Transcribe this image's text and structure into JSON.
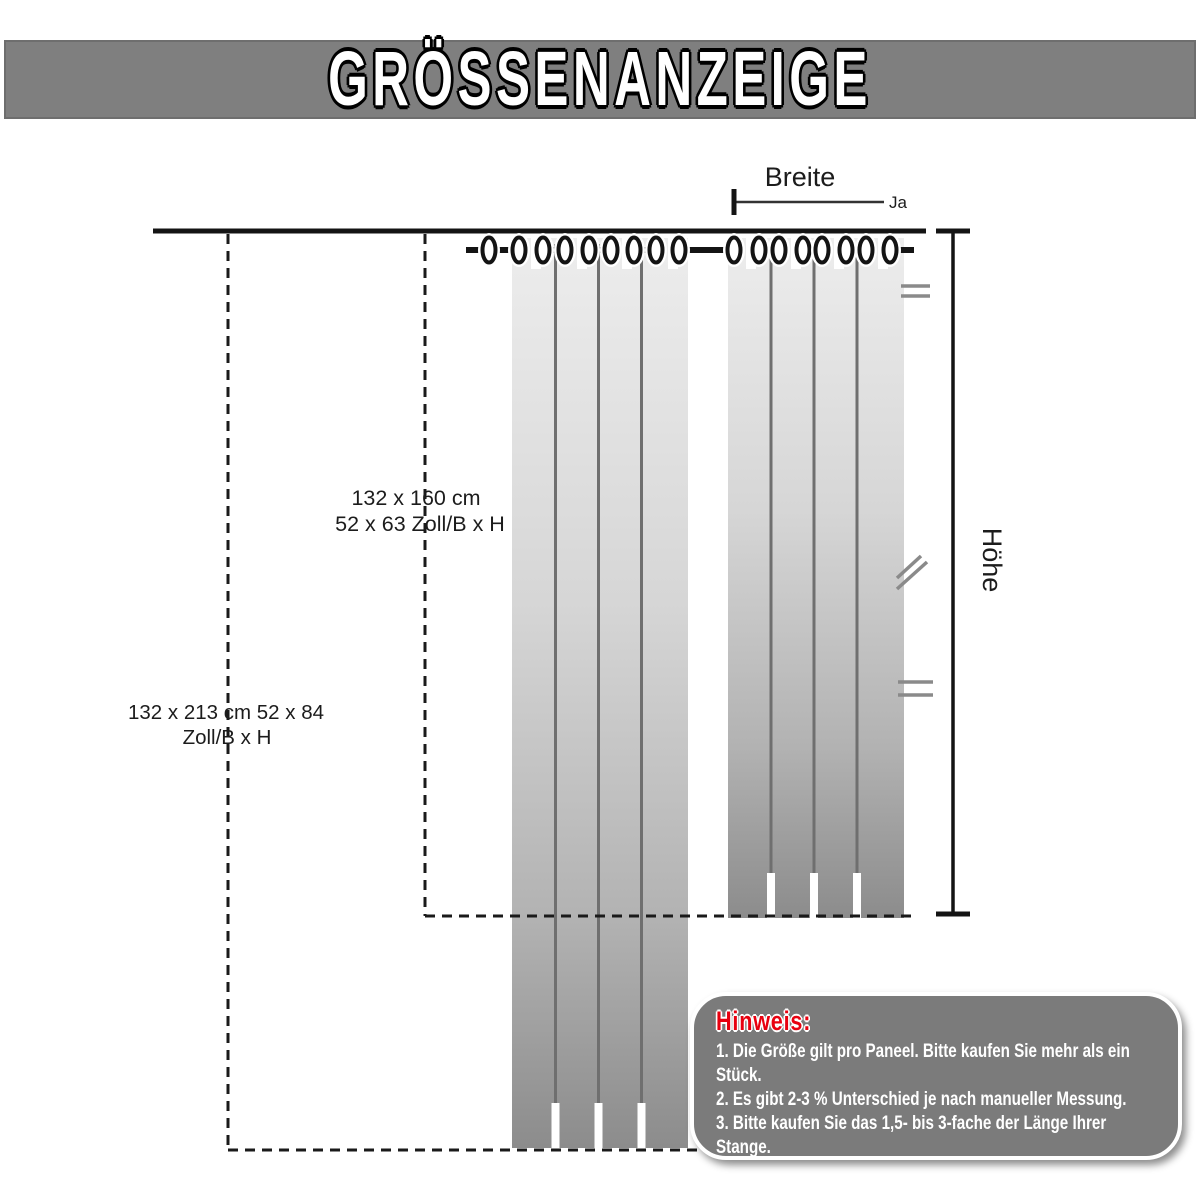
{
  "title": "GRÖSSENANZEIGE",
  "labels": {
    "breite": "Breite",
    "ja": "Ja",
    "hoehe": "Höhe"
  },
  "sizes": {
    "panel1_line1": "132 x 160 cm",
    "panel1_line2": "52 x 63 Zoll/B x H",
    "panel2_line1": "132 x 213 cm 52 x 84",
    "pan2_note": "",
    "panel2_line2": "Zoll/B x H"
  },
  "hinweis": {
    "heading": "Hinweis:",
    "items": [
      "1. Die Größe gilt pro Paneel. Bitte kaufen Sie mehr als ein Stück.",
      "2. Es gibt 2-3 % Unterschied je nach manueller Messung.",
      "3. Bitte kaufen Sie das 1,5- bis 3-fache der Länge Ihrer Stange."
    ]
  },
  "colors": {
    "banner_bg": "#7f7f7f",
    "ink": "#141414",
    "mark_gray": "#8a8a8a",
    "hinweis_bg": "#7b7b7b",
    "hinweis_red": "#e8000f",
    "curtain_top": "#ededed",
    "curtain_bottom": "#8c8c8c"
  },
  "diagram": {
    "ring_y": 250,
    "rings": [
      489,
      519,
      543,
      565,
      589,
      611,
      634,
      656,
      679,
      734,
      759,
      779,
      803,
      822,
      846,
      866,
      890
    ],
    "bars": [
      [
        466,
        525
      ],
      [
        537,
        571
      ],
      [
        583,
        617
      ],
      [
        628,
        662
      ],
      [
        671,
        744
      ],
      [
        751,
        785
      ],
      [
        795,
        829
      ],
      [
        838,
        872
      ],
      [
        882,
        914
      ]
    ],
    "slit_h": 45,
    "curtains": [
      {
        "x": 512,
        "y": 238,
        "w": 176,
        "h": 910,
        "folds": [
          555.5,
          598.5,
          641.5
        ],
        "tabs": [
          531,
          577,
          622,
          668
        ]
      },
      {
        "x": 728,
        "y": 238,
        "w": 176,
        "h": 680,
        "folds": [
          771,
          814,
          857
        ],
        "tabs": [
          746,
          791,
          834,
          878
        ]
      }
    ]
  }
}
